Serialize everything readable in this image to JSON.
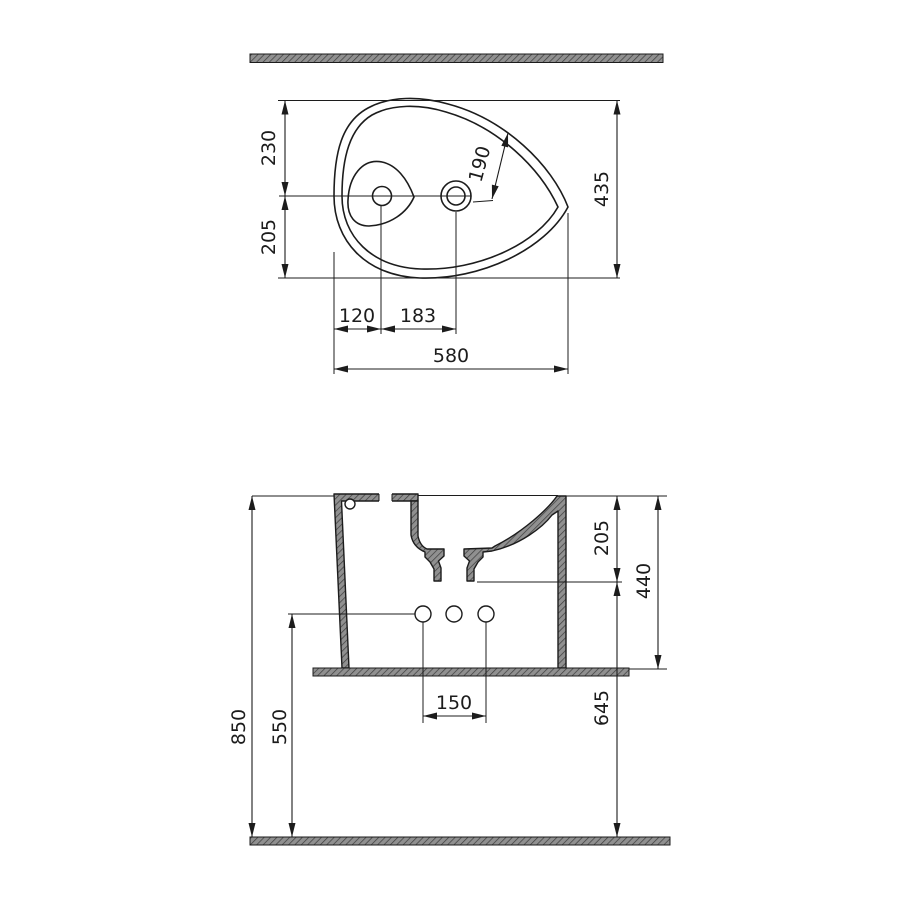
{
  "colors": {
    "background": "#ffffff",
    "line": "#1c1c1c",
    "hatch_fill": "#909090",
    "hatch_line": "#3c3c3c"
  },
  "top_view": {
    "dims": {
      "back_edge_to_centerline": "230",
      "centerline_to_front_edge": "205",
      "faucet_to_rim_diagonal": "190",
      "overall_depth": "435",
      "side_edge_to_drain": "120",
      "drain_to_faucet": "183",
      "overall_width": "580"
    }
  },
  "side_view": {
    "dims": {
      "rim_to_drain_outlet": "205",
      "rim_to_shelf": "440",
      "drain_outlet_to_floor": "645",
      "fixing_hole_spacing": "150",
      "floor_to_fixing_holes": "550",
      "floor_to_rim": "850"
    }
  }
}
